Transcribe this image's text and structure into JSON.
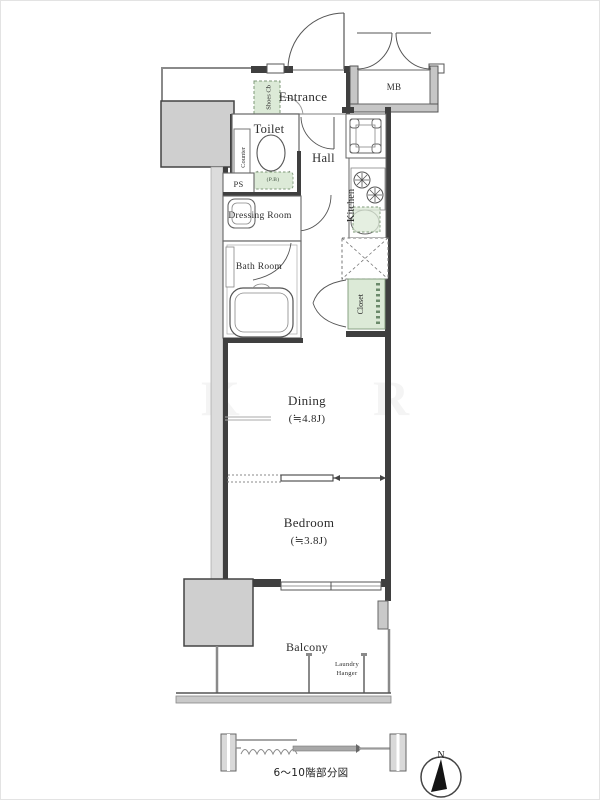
{
  "plan": {
    "type": "apartment-floor-plan",
    "rooms": {
      "entrance": "Entrance",
      "mb": "MB",
      "shoes_cb": "Shoes Cb",
      "toilet": "Toilet",
      "toilet_pb": "(P.B)",
      "counter": "Counter",
      "ps": "PS",
      "hall": "Hall",
      "kitchen": "Kitchen",
      "dressing_room": "Dressing Room",
      "bath_room": "Bath Room",
      "closet": "Closet",
      "dining": {
        "name": "Dining",
        "size": "(≒4.8J)"
      },
      "bedroom": {
        "name": "Bedroom",
        "size": "(≒3.8J)"
      },
      "balcony": "Balcony",
      "laundry_hanger": "Laundry Hanger"
    },
    "footer": {
      "caption": "6〜10階部分図"
    },
    "compass": {
      "north_label": "N"
    },
    "watermark": {
      "left": "K",
      "right": "R"
    },
    "colors": {
      "wall_dark": "#3f3f3f",
      "concrete_gray": "#cfcfcf",
      "storage_green": "#dcead7",
      "storage_green_border": "#7f9a7a"
    }
  }
}
